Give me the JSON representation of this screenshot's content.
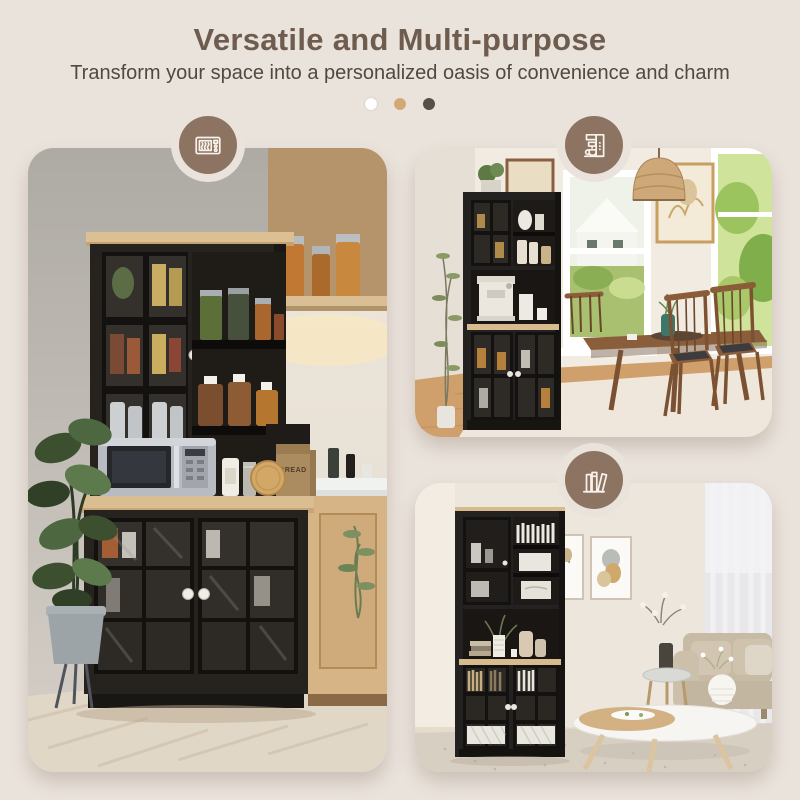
{
  "header": {
    "title": "Versatile and Multi-purpose",
    "subtitle": "Transform your space into a personalized oasis of convenience and charm"
  },
  "carousel": {
    "dots": [
      {
        "index": 1,
        "color": "#ffffff",
        "state": "inactive"
      },
      {
        "index": 2,
        "color": "#d3a877",
        "state": "inactive"
      },
      {
        "index": 3,
        "color": "#575049",
        "state": "active"
      }
    ]
  },
  "panels": [
    {
      "id": "kitchen",
      "badge_icon": "microwave-icon",
      "labels": {
        "bread_box": "BREAD"
      }
    },
    {
      "id": "dining-room",
      "badge_icon": "coffee-maker-icon"
    },
    {
      "id": "living-room",
      "badge_icon": "books-icon"
    }
  ],
  "colors": {
    "background": "#eae3dc",
    "title": "#6e5c4e",
    "subtitle": "#4e4943",
    "badge_circle": "#8d7361",
    "badge_icon_stroke": "#f7f2ea",
    "cabinet_black": "#26231f",
    "wood_accent": "#d9bd90"
  }
}
